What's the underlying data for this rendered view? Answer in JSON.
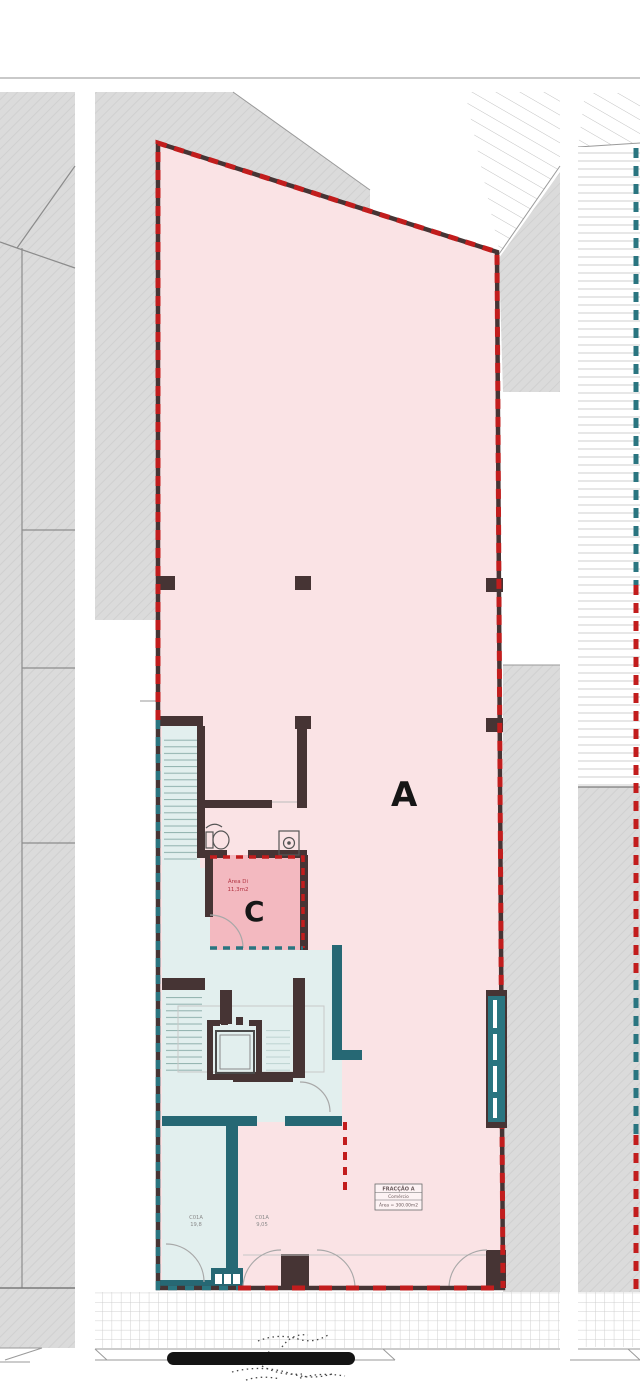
{
  "drawing": {
    "fractions": {
      "a_letter": "A",
      "c_letter": "C",
      "c_area_line1": "Área Di",
      "c_area_line2": "11,3m2"
    },
    "title_block": {
      "title": "FRACÇÃO A",
      "use": "Comércio",
      "area": "Área = 300.00m2"
    },
    "door_labels": {
      "left_code": "C01A",
      "left_value": "19,8",
      "right_code": "C01A",
      "right_value": "9,05"
    },
    "colors": {
      "fraction_a_fill": "#fae3e5",
      "fraction_c_fill": "#f3b9c0",
      "common_area_fill": "#e2efee",
      "neighbor_fill": "#dcdcdc",
      "wall_dark": "#463434",
      "boundary_red": "#c21d1d",
      "boundary_teal": "#2a7580",
      "teal_wall": "#266874",
      "scale_bar": "#141414"
    },
    "icons": [
      "stairs-icon",
      "elevator-icon",
      "toilet-icon",
      "sink-icon",
      "window-icon",
      "scale-bar"
    ]
  }
}
